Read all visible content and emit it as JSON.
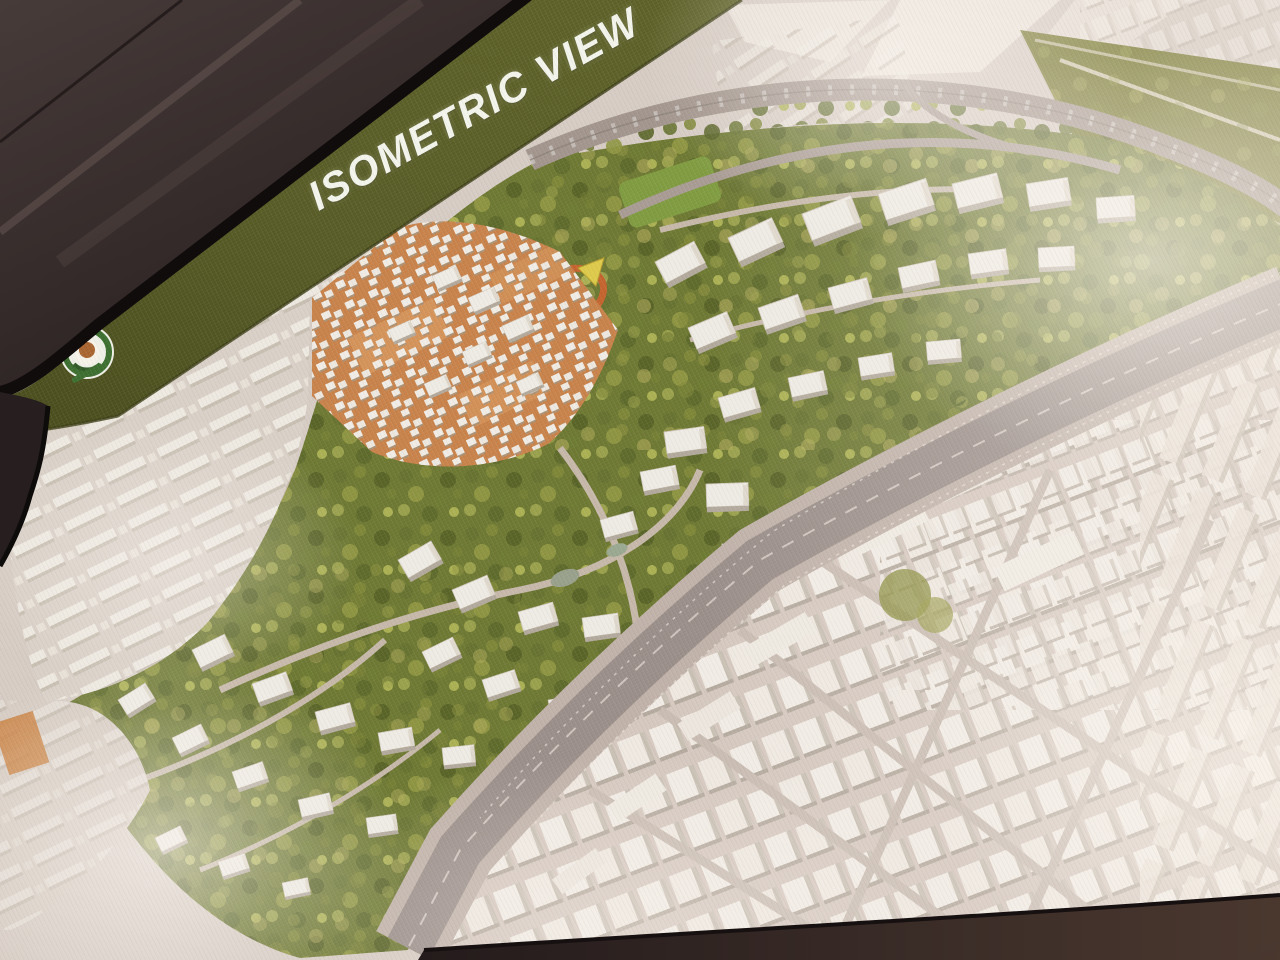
{
  "photo": {
    "description": "Oblique photograph of a projection screen displaying an aerial isometric masterplan rendering slide",
    "slide": {
      "title": "ISOMETRIC VIEW",
      "banner": "olive green diagonal title band along the top edge of the slide",
      "logo": "circular project emblem with green wreath ring and orange-brown center",
      "rendering_areas": [
        {
          "name": "existing-city-district",
          "appearance": "dense washed-out rows of small white buildings, left side"
        },
        {
          "name": "souk-district",
          "appearance": "orange ground plaza with dense cluster of small white buildings"
        },
        {
          "name": "green-campus",
          "appearance": "wooded parkland with scattered white low-rise buildings and curved lanes"
        },
        {
          "name": "central-lawn",
          "appearance": "rectangular green open lawn"
        },
        {
          "name": "yellow-landmark-building",
          "appearance": "small yellow triangular pavilion"
        },
        {
          "name": "running-track",
          "appearance": "small orange oval track"
        },
        {
          "name": "curved-highway",
          "appearance": "curved arterial road across the top"
        },
        {
          "name": "main-boulevard",
          "appearance": "wide diagonal avenue with parking rows and tree-lined median"
        },
        {
          "name": "linear-halls",
          "appearance": "long white curved halls beside the boulevard"
        },
        {
          "name": "logistics-district",
          "appearance": "large grid of white warehouse units, right and bottom right"
        },
        {
          "name": "farm-fields",
          "appearance": "olive green plots at top right"
        },
        {
          "name": "development-pads",
          "appearance": "large empty white parcels beyond the highway"
        }
      ]
    },
    "room": {
      "visible_parts": [
        "dark ceiling panels at top left",
        "black screen bezel edge",
        "dark wall strip below the screen"
      ]
    },
    "colors": {
      "banner": "#565a24",
      "title": "#f3f5ec",
      "room_dark": "#362c2b",
      "bezel": "#100c0c",
      "slide_base": "#d6ccc4",
      "souk_ground": "#c8824a",
      "tree_green": "#6d7832",
      "field_olive": "#75772e",
      "building_white": "#efeae3",
      "road_gray": "#9a8e89",
      "glare": "#fdf8f1"
    }
  }
}
